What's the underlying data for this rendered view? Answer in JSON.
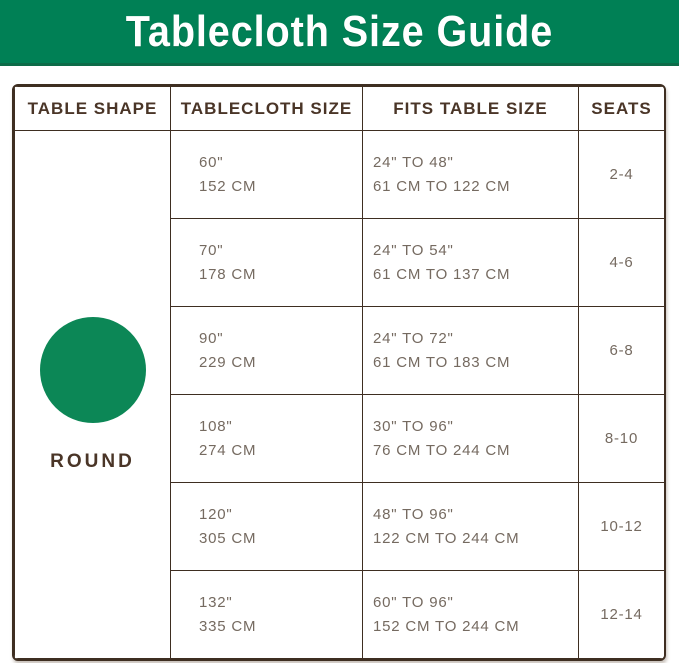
{
  "chart_data": {
    "type": "table",
    "title": "Tablecloth Size Guide",
    "columns": [
      "TABLE SHAPE",
      "TABLECLOTH SIZE",
      "FITS TABLE SIZE",
      "SEATS"
    ],
    "table_shape": "ROUND",
    "rows": [
      {
        "tablecloth_size": [
          "60\"",
          "152 CM"
        ],
        "fits_table_size": [
          "24\" TO 48\"",
          "61 CM TO 122 CM"
        ],
        "seats": "2-4"
      },
      {
        "tablecloth_size": [
          "70\"",
          "178 CM"
        ],
        "fits_table_size": [
          "24\" TO 54\"",
          "61 CM TO 137 CM"
        ],
        "seats": "4-6"
      },
      {
        "tablecloth_size": [
          "90\"",
          "229 CM"
        ],
        "fits_table_size": [
          "24\" TO 72\"",
          "61 CM TO 183 CM"
        ],
        "seats": "6-8"
      },
      {
        "tablecloth_size": [
          "108\"",
          "274 CM"
        ],
        "fits_table_size": [
          "30\" TO 96\"",
          "76 CM TO 244 CM"
        ],
        "seats": "8-10"
      },
      {
        "tablecloth_size": [
          "120\"",
          "305 CM"
        ],
        "fits_table_size": [
          "48\" TO 96\"",
          "122 CM TO 244 CM"
        ],
        "seats": "10-12"
      },
      {
        "tablecloth_size": [
          "132\"",
          "335 CM"
        ],
        "fits_table_size": [
          "60\" TO 96\"",
          "152 CM TO 244 CM"
        ],
        "seats": "12-14"
      }
    ]
  },
  "colors": {
    "banner_green": "#008055",
    "banner_edge_green": "#0c6b48",
    "shape_circle_green": "#0c8756",
    "border_brown": "#3e2e21",
    "header_text_brown": "#4a3527",
    "body_text_gray_brown": "#756a60",
    "title_text": "#ffffff"
  }
}
